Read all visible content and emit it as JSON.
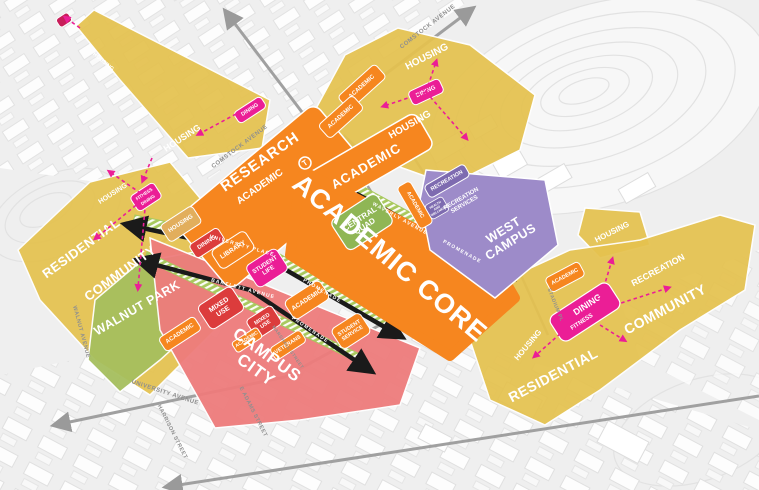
{
  "colors": {
    "orange": "#F6861F",
    "yellow": "#E5C24F",
    "tan": "#E2AE5C",
    "red": "#DC3C3C",
    "salmon": "#EE7C7C",
    "magenta": "#EB1E96",
    "green": "#9FBE59",
    "quad_green": "#8FB655",
    "hatch_green": "#A8C95E",
    "purple": "#9D8BC9",
    "purple_dark": "#7E6BB0",
    "arrow_black": "#1A1A1A",
    "road_gray": "#A0A0A0"
  },
  "streets": {
    "comstock": "COMSTOCK AVENUE",
    "walnut": "WALNUT AVENUE",
    "university_avenue": "UNIVERSITY AVENUE",
    "adams": "E ADAMS STREET",
    "harrison": "HARRISON STREET",
    "marshall": "MARSHALL STREET",
    "stadium": "STADIUM PL"
  },
  "promenades": {
    "north": {
      "street": "WAVERLY AVENUE",
      "type": "PROMENADE"
    },
    "middle": {
      "street": "UNIVERSITY PLACE",
      "type": "PROMENADE"
    },
    "south": {
      "street": "BARTLETT AVENUE",
      "type": "PROMENADE"
    }
  },
  "core": {
    "label": "ACADEMIC CORE",
    "central_quad": "CENTRAL QUAD",
    "academic_strip": "ACADEMIC",
    "academic_east": "ACADEMIC"
  },
  "research": {
    "label": "RESEARCH",
    "academic": "ACADEMIC",
    "transit": "T"
  },
  "west_campus": {
    "label": "WEST CAMPUS",
    "recreation": "RECREATION",
    "recreation_services": "RECREATION SERVICES",
    "health_wellness": "HEALTH AND WELLNESS"
  },
  "north_housing": {
    "housing_upper": "HOUSING",
    "housing_lower": "HOUSING",
    "dining": "DINING",
    "academic_1": "ACADEMIC",
    "academic_2": "ACADEMIC"
  },
  "northwest_strip": {
    "housing_1": "HOUSING",
    "housing_2": "HOUSING",
    "dining": "DINING"
  },
  "west_neighborhood": {
    "residential": "RESIDENTIAL",
    "community": "COMMUNITY",
    "housing": "HOUSING",
    "fitness": "FITNESS",
    "dining": "DINING"
  },
  "walnut_park": {
    "label": "WALNUT PARK"
  },
  "campus_city": {
    "label": "CAMPUS CITY",
    "housing": "HOUSING",
    "dining": "DINING",
    "library": "LIBRARY",
    "student_life": "STUDENT LIFE",
    "academic_r1": "ACADEMIC",
    "academic_w": "ACADEMIC",
    "mixed_use_1": "MIXED USE",
    "mixed_use_2": "MIXED USE",
    "academic_s": "ACADEMIC",
    "veterans": "VETERANS",
    "student_service": "STUDENT SERVICE"
  },
  "east_housing": {
    "label": "HOUSING"
  },
  "east_neighborhood": {
    "residential": "RESIDENTIAL",
    "community": "COMMUNITY",
    "recreation": "RECREATION",
    "housing": "HOUSING",
    "dining": "DINING",
    "fitness": "FITNESS",
    "academic": "ACADEMIC"
  }
}
